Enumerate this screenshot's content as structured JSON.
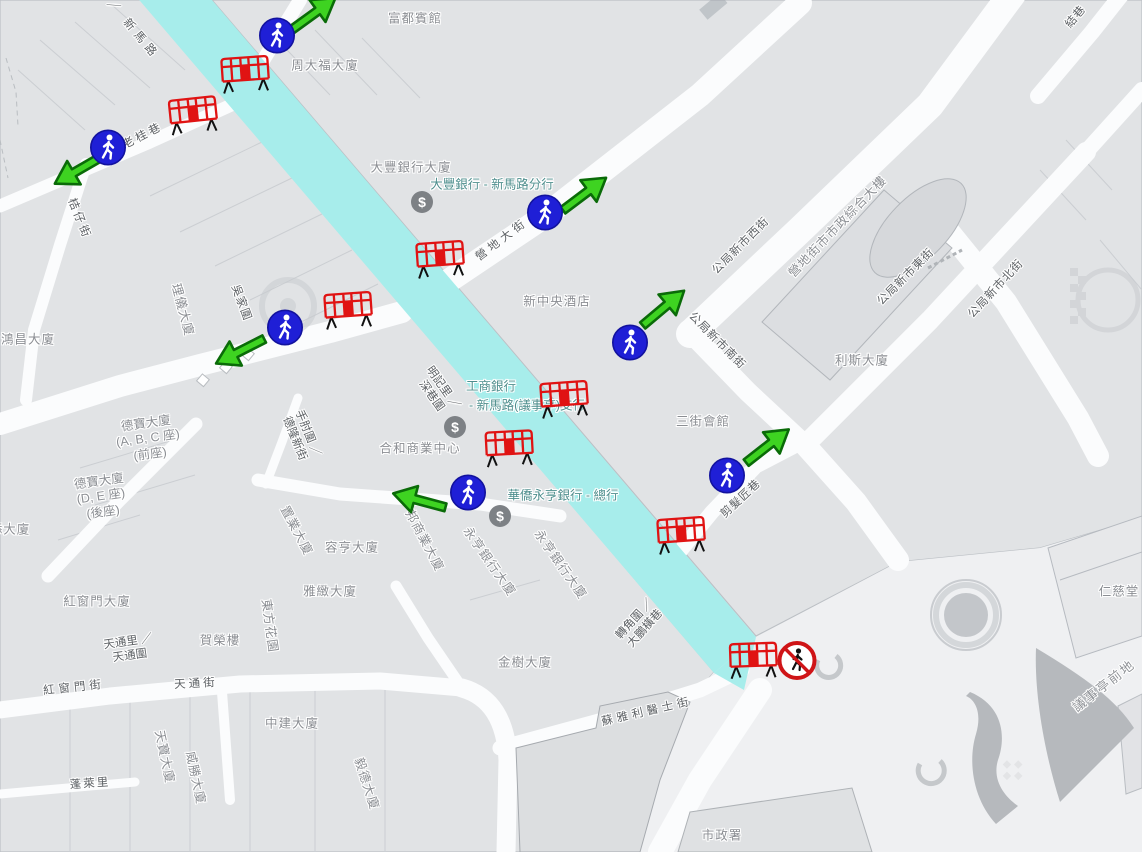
{
  "map": {
    "colors": {
      "closed_road_cyan": "#a7edeb",
      "arrow_green": "#3ed321",
      "arrow_border": "#0a6b08",
      "pedestrian_blue": "#1f1fd6",
      "barrier_red": "#e01313",
      "no_entry_red": "#cf1417",
      "poi_teal": "#4f8f8e"
    },
    "labels": [
      {
        "type": "street",
        "lines": [
          "／ 新馬路"
        ],
        "x": 133,
        "y": 30,
        "rot": 50,
        "ls": 5
      },
      {
        "type": "street",
        "lines": [
          "老桂巷"
        ],
        "x": 143,
        "y": 136,
        "rot": -27,
        "ls": 3
      },
      {
        "type": "street",
        "lines": [
          "桔仔街"
        ],
        "x": 79,
        "y": 219,
        "rot": 68,
        "ls": 3
      },
      {
        "type": "street",
        "lines": [
          "營地大街"
        ],
        "x": 502,
        "y": 240,
        "rot": -37,
        "ls": 4
      },
      {
        "type": "street",
        "lines": [
          "公局新市西街"
        ],
        "x": 741,
        "y": 246,
        "rot": -45,
        "ls": 1
      },
      {
        "type": "street",
        "lines": [
          "公局新市南街"
        ],
        "x": 717,
        "y": 341,
        "rot": 45,
        "ls": 1
      },
      {
        "type": "street",
        "lines": [
          "公局新市東街"
        ],
        "x": 906,
        "y": 277,
        "rot": -45,
        "ls": 1
      },
      {
        "type": "street",
        "lines": [
          "公局新市北街"
        ],
        "x": 996,
        "y": 289,
        "rot": -47,
        "ls": 1
      },
      {
        "type": "street",
        "lines": [
          "剪髮匠巷"
        ],
        "x": 741,
        "y": 499,
        "rot": -43,
        "ls": 1
      },
      {
        "type": "street",
        "lines": [
          "蘇雅利醫士街"
        ],
        "x": 647,
        "y": 712,
        "rot": -13,
        "ls": 4
      },
      {
        "type": "street",
        "lines": [
          "紅窗門街"
        ],
        "x": 74,
        "y": 688,
        "rot": -6,
        "ls": 4
      },
      {
        "type": "street",
        "lines": [
          "天通街"
        ],
        "x": 196,
        "y": 684,
        "rot": -3,
        "ls": 3
      },
      {
        "type": "street",
        "lines": [
          "蓬萊里"
        ],
        "x": 90,
        "y": 784,
        "rot": -4,
        "ls": 2
      },
      {
        "type": "street",
        "lines": [
          "手肘圍 ／",
          "德隆新街"
        ],
        "x": 301,
        "y": 436,
        "rot": 68
      },
      {
        "type": "street",
        "lines": [
          "明記里 ／",
          "深巷圍"
        ],
        "x": 437,
        "y": 392,
        "rot": 55
      },
      {
        "type": "street",
        "lines": [
          "吳家圍"
        ],
        "x": 241,
        "y": 303,
        "rot": 70,
        "ls": 1
      },
      {
        "type": "street",
        "lines": [
          "天通里 ／",
          "天通圍"
        ],
        "x": 129,
        "y": 649,
        "rot": -8
      },
      {
        "type": "street",
        "lines": [
          "轉角圍 ／",
          "大鵬橫巷"
        ],
        "x": 640,
        "y": 624,
        "rot": -48
      },
      {
        "type": "street",
        "lines": [
          "結巷"
        ],
        "x": 1076,
        "y": 17,
        "rot": -50,
        "ls": 1
      },
      {
        "type": "area",
        "lines": [
          "議事亭前地"
        ],
        "x": 1104,
        "y": 686,
        "rot": -38,
        "ls": 2
      },
      {
        "type": "building",
        "lines": [
          "富都賓館"
        ],
        "x": 415,
        "y": 19,
        "rot": 0,
        "ls": 1
      },
      {
        "type": "building",
        "lines": [
          "周大福大廈"
        ],
        "x": 325,
        "y": 66,
        "rot": 0,
        "ls": 1
      },
      {
        "type": "building",
        "lines": [
          "大豐銀行大廈"
        ],
        "x": 411,
        "y": 168,
        "rot": 0,
        "ls": 1
      },
      {
        "type": "building",
        "lines": [
          "新中央酒店"
        ],
        "x": 557,
        "y": 302,
        "rot": 0,
        "ls": 1
      },
      {
        "type": "building",
        "lines": [
          "營地街市市政綜合大樓"
        ],
        "x": 838,
        "y": 227,
        "rot": -46,
        "ls": 1
      },
      {
        "type": "building",
        "lines": [
          "利斯大廈"
        ],
        "x": 862,
        "y": 361,
        "rot": 0,
        "ls": 1
      },
      {
        "type": "building",
        "lines": [
          "三街會館"
        ],
        "x": 703,
        "y": 422,
        "rot": 0,
        "ls": 1
      },
      {
        "type": "building",
        "lines": [
          "合和商業中心"
        ],
        "x": 420,
        "y": 449,
        "rot": 0,
        "ls": 1
      },
      {
        "type": "building",
        "lines": [
          "鴻昌大廈"
        ],
        "x": 28,
        "y": 340,
        "rot": 0,
        "ls": 1
      },
      {
        "type": "building",
        "lines": [
          "理儀大廈"
        ],
        "x": 182,
        "y": 310,
        "rot": 75,
        "ls": 1
      },
      {
        "type": "building",
        "lines": [
          "德寶大廈",
          "(A, B, C 座)",
          "(前座)"
        ],
        "x": 148,
        "y": 439,
        "rot": -8
      },
      {
        "type": "building",
        "lines": [
          "德寶大廈",
          "(D, E 座)",
          "(後座)"
        ],
        "x": 101,
        "y": 497,
        "rot": -8
      },
      {
        "type": "building",
        "lines": [
          "紅窗門大廈"
        ],
        "x": 97,
        "y": 602,
        "rot": 0,
        "ls": 1
      },
      {
        "type": "building",
        "lines": [
          "賀榮樓"
        ],
        "x": 220,
        "y": 641,
        "rot": 0,
        "ls": 1
      },
      {
        "type": "building",
        "lines": [
          "東方花園"
        ],
        "x": 269,
        "y": 626,
        "rot": 82,
        "ls": 1
      },
      {
        "type": "building",
        "lines": [
          "雅緻大廈"
        ],
        "x": 330,
        "y": 592,
        "rot": 0,
        "ls": 1
      },
      {
        "type": "building",
        "lines": [
          "容亨大廈"
        ],
        "x": 352,
        "y": 548,
        "rot": 0,
        "ls": 1
      },
      {
        "type": "building",
        "lines": [
          "置業大廈"
        ],
        "x": 296,
        "y": 531,
        "rot": 62,
        "ls": 1
      },
      {
        "type": "building",
        "lines": [
          "邦商業大廈"
        ],
        "x": 424,
        "y": 541,
        "rot": 62,
        "ls": 1
      },
      {
        "type": "building",
        "lines": [
          "永亨銀行大廈"
        ],
        "x": 489,
        "y": 562,
        "rot": 55,
        "ls": 1
      },
      {
        "type": "building",
        "lines": [
          "永亨銀行大廈"
        ],
        "x": 560,
        "y": 565,
        "rot": 55,
        "ls": 1
      },
      {
        "type": "building",
        "lines": [
          "天寶大廈"
        ],
        "x": 164,
        "y": 757,
        "rot": 78,
        "ls": 1
      },
      {
        "type": "building",
        "lines": [
          "威勝大廈"
        ],
        "x": 195,
        "y": 778,
        "rot": 78,
        "ls": 1
      },
      {
        "type": "building",
        "lines": [
          "中建大廈"
        ],
        "x": 292,
        "y": 724,
        "rot": 0,
        "ls": 1
      },
      {
        "type": "building",
        "lines": [
          "金樹大廈"
        ],
        "x": 525,
        "y": 663,
        "rot": 0,
        "ls": 1
      },
      {
        "type": "building",
        "lines": [
          "毅德大廈"
        ],
        "x": 366,
        "y": 784,
        "rot": 72,
        "ls": 1
      },
      {
        "type": "building",
        "lines": [
          "仁慈堂"
        ],
        "x": 1119,
        "y": 592,
        "rot": 0,
        "ls": 1
      },
      {
        "type": "building",
        "lines": [
          "市政署"
        ],
        "x": 722,
        "y": 836,
        "rot": 0,
        "ls": 1
      },
      {
        "type": "building",
        "lines": [
          "添大廈"
        ],
        "x": 10,
        "y": 530,
        "rot": 0,
        "ls": 1
      },
      {
        "type": "poi",
        "lines": [
          "大豐銀行 - 新馬路分行"
        ],
        "x": 492,
        "y": 185,
        "rot": 0
      },
      {
        "type": "poi",
        "lines": [
          "工商銀行"
        ],
        "x": 491,
        "y": 387,
        "rot": 0
      },
      {
        "type": "poi",
        "lines": [
          "- 新馬路(議事亭)支行"
        ],
        "x": 527,
        "y": 406,
        "rot": 0
      },
      {
        "type": "poi",
        "lines": [
          "華僑永亨銀行 - 總行"
        ],
        "x": 563,
        "y": 496,
        "rot": 0
      }
    ],
    "markers": {
      "pedestrian_crossings": [
        {
          "x": 277,
          "y": 38
        },
        {
          "x": 108,
          "y": 150
        },
        {
          "x": 285,
          "y": 330
        },
        {
          "x": 545,
          "y": 215
        },
        {
          "x": 630,
          "y": 345
        },
        {
          "x": 468,
          "y": 495
        },
        {
          "x": 727,
          "y": 478
        }
      ],
      "direction_arrows": [
        {
          "x": 315,
          "y": 16,
          "rot": -36
        },
        {
          "x": 77,
          "y": 168,
          "rot": 150
        },
        {
          "x": 239,
          "y": 349,
          "rot": 153
        },
        {
          "x": 586,
          "y": 196,
          "rot": -37
        },
        {
          "x": 665,
          "y": 310,
          "rot": -40
        },
        {
          "x": 420,
          "y": 498,
          "rot": 195
        },
        {
          "x": 769,
          "y": 448,
          "rot": -38
        }
      ],
      "barriers": [
        {
          "x": 245,
          "y": 76,
          "rot": -4
        },
        {
          "x": 193,
          "y": 117,
          "rot": -6
        },
        {
          "x": 348,
          "y": 312,
          "rot": -4
        },
        {
          "x": 440,
          "y": 261,
          "rot": -4
        },
        {
          "x": 564,
          "y": 401,
          "rot": -4
        },
        {
          "x": 509,
          "y": 450,
          "rot": -3
        },
        {
          "x": 681,
          "y": 537,
          "rot": -4
        },
        {
          "x": 753,
          "y": 662,
          "rot": -2
        }
      ],
      "no_pedestrian_signs": [
        {
          "x": 797,
          "y": 663
        }
      ],
      "atm_icons": [
        {
          "x": 422,
          "y": 202,
          "symbol": "$"
        },
        {
          "x": 455,
          "y": 427,
          "symbol": "$"
        },
        {
          "x": 500,
          "y": 516,
          "symbol": "$"
        }
      ]
    }
  }
}
